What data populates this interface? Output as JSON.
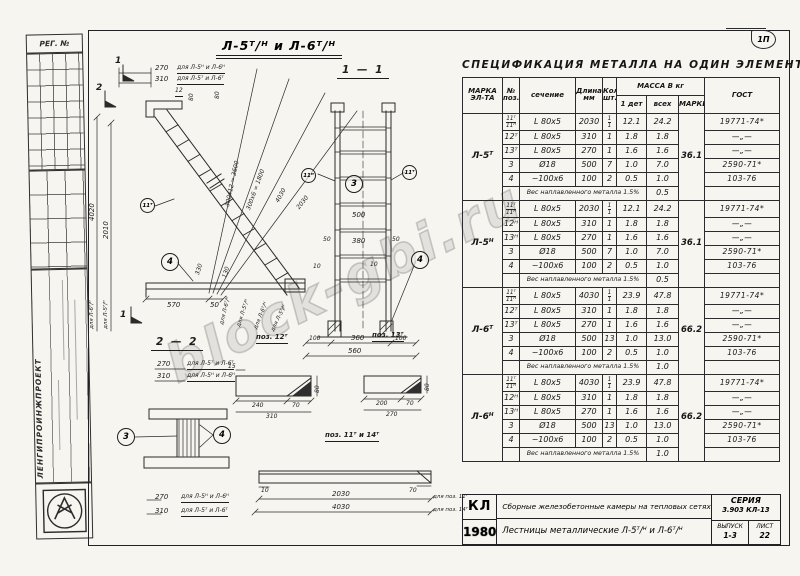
{
  "meta": {
    "reg_label": "РЕГ. №",
    "org_name": "ЛЕНГИПРОИНЖПРОЕКТ",
    "corner_stamp": "1П",
    "watermark": "block-gbi.ru"
  },
  "drawing": {
    "main_title": "Л-5ᵀ/ᴴ  и  Л-6ᵀ/ᴴ",
    "marker_1": "1",
    "marker_2": "2",
    "top_dim_270": "270",
    "top_note_270": "для Л-5ᴴ и Л-6ᴴ",
    "top_dim_310": "310",
    "top_note_310": "для Л-5ᵀ и Л-6ᵀ",
    "lbl_12": "12",
    "lbl_80a": "80",
    "lbl_80b": "80",
    "left_dim_4020": "4020",
    "left_note_4020": "для Л-6ᵀ/ᴴ",
    "left_dim_2010": "2010",
    "left_note_2010": "для Л-5ᵀ/ᴴ",
    "diag_dim_1": "300х12 = 3600",
    "diag_note_1": "для Л-6ᵀ/ᴴ",
    "diag_dim_2": "300х6 = 1800",
    "diag_note_2": "для Л-5ᵀ/ᴴ",
    "diag_dim_3": "4030",
    "diag_note_3": "для Л-6ᵀ/ᴴ",
    "diag_dim_4": "2030",
    "diag_note_4": "для Л-5ᵀ/ᴴ",
    "dim_330": "330",
    "dim_130": "130",
    "dim_570": "570",
    "dim_50": "50",
    "balloon_11t": "11ᵀ",
    "balloon_11n": "11ᴴ",
    "balloon_3": "3",
    "balloon_4": "4",
    "s11_title": "1 — 1",
    "s11": {
      "dim_500": "500",
      "dim_380": "380",
      "dim_50l": "50",
      "dim_50r": "50",
      "dim_10l": "10",
      "dim_10r": "10",
      "dim_100l": "100",
      "dim_360": "360",
      "dim_100r": "100",
      "dim_560": "560"
    },
    "s22_title": "2 — 2",
    "s22": {
      "dim_270": "270",
      "note_270": "для Л-5ᵀ и Л-6ᵀ",
      "dim_310": "310",
      "note_310": "для Л-5ᴴ и Л-6ᴴ"
    },
    "pos12_title": "поз. 12ᵀ",
    "p12": {
      "dim_15": "15",
      "dim_240": "240",
      "dim_70": "70",
      "dim_310": "310",
      "dim_80": "80"
    },
    "pos13_title": "поз. 13ᵀ",
    "p13": {
      "dim_200": "200",
      "dim_70": "70",
      "dim_270": "270",
      "dim_80": "80"
    },
    "pos11_14_title": "поз. 11ᵀ и 14ᵀ",
    "bar": {
      "dim_10": "10",
      "dim_70": "70",
      "dim_2030": "2030",
      "note_2030": "для поз. 11ᵀ",
      "dim_4030": "4030",
      "note_4030": "для поз. 14ᵀ",
      "dim_270": "270",
      "note_270": "для Л-5ᴴ и Л-6ᴴ",
      "dim_310": "310",
      "note_310": "для Л-5ᵀ и Л-6ᵀ"
    }
  },
  "spec_table": {
    "title": "СПЕЦИФИКАЦИЯ  МЕТАЛЛА  НА  ОДИН  ЭЛЕМЕНТ.",
    "headers": {
      "mark": "МАРКА\nЭЛ-ТА",
      "pos": "№\nпоз.",
      "section": "сечение",
      "length": "Длина\nмм",
      "qty": "Кол.\nшт.",
      "mass_group": "МАССА В кг",
      "mass_one": "1 дет",
      "mass_all": "всех",
      "mass_mark": "МАРКИ",
      "gost": "ГОСТ"
    },
    "groups": [
      {
        "mark": "Л-5ᵀ",
        "mark_mass": "36.1",
        "rows": [
          {
            "pos": "11ᵀ|11ᴴ",
            "section": "L 80х5",
            "length": "2030",
            "qty": "1|1",
            "mass_one": "12.1",
            "mass_all": "24.2",
            "gost": "19771-74*"
          },
          {
            "pos": "12ᵀ",
            "section": "L 80х5",
            "length": "310",
            "qty": "1",
            "mass_one": "1.8",
            "mass_all": "1.8",
            "gost": "—„—"
          },
          {
            "pos": "13ᵀ",
            "section": "L 80х5",
            "length": "270",
            "qty": "1",
            "mass_one": "1.6",
            "mass_all": "1.6",
            "gost": "—„—"
          },
          {
            "pos": "3",
            "section": "Ø18",
            "length": "500",
            "qty": "7",
            "mass_one": "1.0",
            "mass_all": "7.0",
            "gost": "2590-71*"
          },
          {
            "pos": "4",
            "section": "−100х6",
            "length": "100",
            "qty": "2",
            "mass_one": "0.5",
            "mass_all": "1.0",
            "gost": "103-76"
          }
        ],
        "weld_note": "Вес наплавленного металла  1.5%",
        "weld_mass": "0.5"
      },
      {
        "mark": "Л-5ᴴ",
        "mark_mass": "36.1",
        "rows": [
          {
            "pos": "11ᵀ|11ᴴ",
            "section": "L 80х5",
            "length": "2030",
            "qty": "1|1",
            "mass_one": "12.1",
            "mass_all": "24.2",
            "gost": "19771-74*"
          },
          {
            "pos": "12ᴴ",
            "section": "L 80х5",
            "length": "310",
            "qty": "1",
            "mass_one": "1.8",
            "mass_all": "1.8",
            "gost": "—„—"
          },
          {
            "pos": "13ᴴ",
            "section": "L 80х5",
            "length": "270",
            "qty": "1",
            "mass_one": "1.6",
            "mass_all": "1.6",
            "gost": "—„—"
          },
          {
            "pos": "3",
            "section": "Ø18",
            "length": "500",
            "qty": "7",
            "mass_one": "1.0",
            "mass_all": "7.0",
            "gost": "2590-71*"
          },
          {
            "pos": "4",
            "section": "−100х6",
            "length": "100",
            "qty": "2",
            "mass_one": "0.5",
            "mass_all": "1.0",
            "gost": "103-76"
          }
        ],
        "weld_note": "Вес наплавленного металла  1.5%",
        "weld_mass": "0.5"
      },
      {
        "mark": "Л-6ᵀ",
        "mark_mass": "66.2",
        "rows": [
          {
            "pos": "11ᵀ|11ᴴ",
            "section": "L 80х5",
            "length": "4030",
            "qty": "1|1",
            "mass_one": "23.9",
            "mass_all": "47.8",
            "gost": "19771-74*"
          },
          {
            "pos": "12ᵀ",
            "section": "L 80х5",
            "length": "310",
            "qty": "1",
            "mass_one": "1.8",
            "mass_all": "1.8",
            "gost": "—„—"
          },
          {
            "pos": "13ᵀ",
            "section": "L 80х5",
            "length": "270",
            "qty": "1",
            "mass_one": "1.6",
            "mass_all": "1.6",
            "gost": "—„—"
          },
          {
            "pos": "3",
            "section": "Ø18",
            "length": "500",
            "qty": "13",
            "mass_one": "1.0",
            "mass_all": "13.0",
            "gost": "2590-71*"
          },
          {
            "pos": "4",
            "section": "−100х6",
            "length": "100",
            "qty": "2",
            "mass_one": "0.5",
            "mass_all": "1.0",
            "gost": "103-76"
          }
        ],
        "weld_note": "Вес наплавленного металла  1.5%",
        "weld_mass": "1.0"
      },
      {
        "mark": "Л-6ᴴ",
        "mark_mass": "66.2",
        "rows": [
          {
            "pos": "11ᵀ|11ᴴ",
            "section": "L 80х5",
            "length": "4030",
            "qty": "1|1",
            "mass_one": "23.9",
            "mass_all": "47.8",
            "gost": "19771-74*"
          },
          {
            "pos": "12ᴴ",
            "section": "L 80х5",
            "length": "310",
            "qty": "1",
            "mass_one": "1.8",
            "mass_all": "1.8",
            "gost": "—„—"
          },
          {
            "pos": "13ᴴ",
            "section": "L 80х5",
            "length": "270",
            "qty": "1",
            "mass_one": "1.6",
            "mass_all": "1.6",
            "gost": "—„—"
          },
          {
            "pos": "3",
            "section": "Ø18",
            "length": "500",
            "qty": "13",
            "mass_one": "1.0",
            "mass_all": "13.0",
            "gost": "2590-71*"
          },
          {
            "pos": "4",
            "section": "−100х6",
            "length": "100",
            "qty": "2",
            "mass_one": "0.5",
            "mass_all": "1.0",
            "gost": "103-76"
          }
        ],
        "weld_note": "Вес наплавленного металла  1.5%",
        "weld_mass": "1.0"
      }
    ]
  },
  "title_block": {
    "stamp_top": "КЛ",
    "stamp_year": "1980",
    "line1": "Сборные железобетонные камеры на тепловых сетях",
    "line2": "Лестницы металлические  Л-5ᵀ/ᴴ  и  Л-6ᵀ/ᴴ",
    "series_label": "СЕРИЯ",
    "series_value": "3.903 КЛ-13",
    "issue_label": "ВЫПУСК",
    "issue_value": "1-3",
    "sheet_label": "ЛИСТ",
    "sheet_value": "22"
  }
}
